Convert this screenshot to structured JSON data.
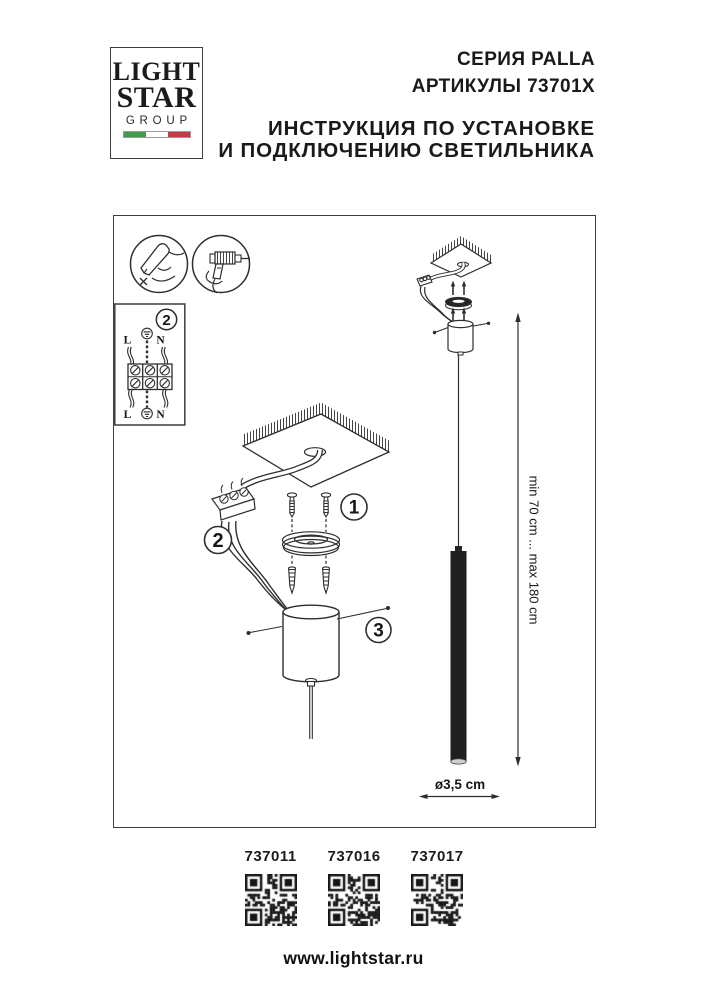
{
  "logo": {
    "word1": "LIGHT",
    "word2": "STAR",
    "word3": "GROUP"
  },
  "header": {
    "series": "СЕРИЯ PALLA",
    "articles": "АРТИКУЛЫ 73701X",
    "title_line1": "ИНСТРУКЦИЯ ПО УСТАНОВКЕ",
    "title_line2": "И ПОДКЛЮЧЕНИЮ СВЕТИЛЬНИКА"
  },
  "diagram": {
    "step1": "1",
    "step2": "2",
    "step3": "3",
    "wiring_detail": {
      "step": "2",
      "line_top": "L",
      "neutral_top": "N",
      "line_bottom": "L",
      "neutral_bottom": "N"
    },
    "height_range": "min 70 cm ... max 180 cm",
    "diameter": "ø3,5 cm"
  },
  "products": [
    {
      "article": "737011"
    },
    {
      "article": "737016"
    },
    {
      "article": "737017"
    }
  ],
  "footer": {
    "website": "www.lightstar.ru"
  },
  "colors": {
    "line": "#2e2e2e",
    "flag_green": "#3f9e4d",
    "flag_white": "#ffffff",
    "flag_red": "#c63a44"
  }
}
